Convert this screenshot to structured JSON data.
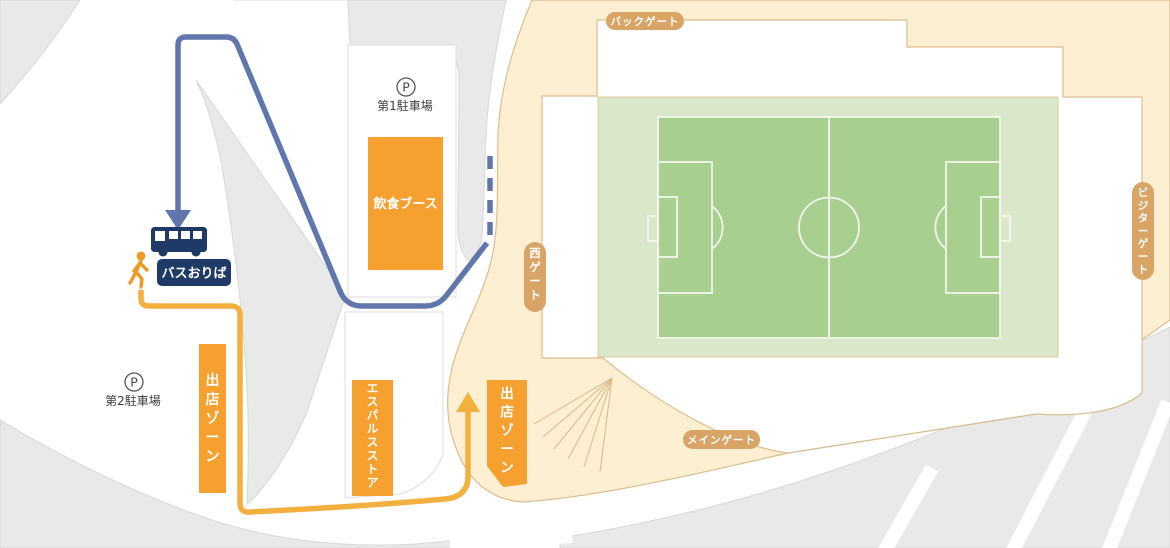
{
  "title": "スタジアム周辺アクセスマップ",
  "labels": {
    "back_gate": "バックゲート",
    "west_gate": "西ゲート",
    "visitor_gate": "ビジターゲート",
    "main_gate": "メインゲート",
    "parking_symbol": "P",
    "parking1": "第1駐車場",
    "parking2": "第2駐車場",
    "food_booth": "飲食ブース",
    "vendor_zone_west": "出店ゾーン",
    "vendor_zone_main": "出店ゾーン",
    "spulse_store": "エスパルスストア",
    "bus_stop": "バスおりば"
  },
  "colors": {
    "concourse_cream": "#fcefd2",
    "border_tan": "#dbbd90",
    "gate_pill_tan": "#d9a567",
    "zone_orange": "#f5a02f",
    "route_orange": "#f2b13e",
    "walker_orange": "#ef9a28",
    "route_blue": "#6176ac",
    "bus_navy": "#1f3a67",
    "pitch_green": "#a9cf90",
    "pitch_surround_green": "#d9e8ca",
    "pitch_line": "#f2f7ec",
    "road_gray": "#e9e9e9"
  }
}
